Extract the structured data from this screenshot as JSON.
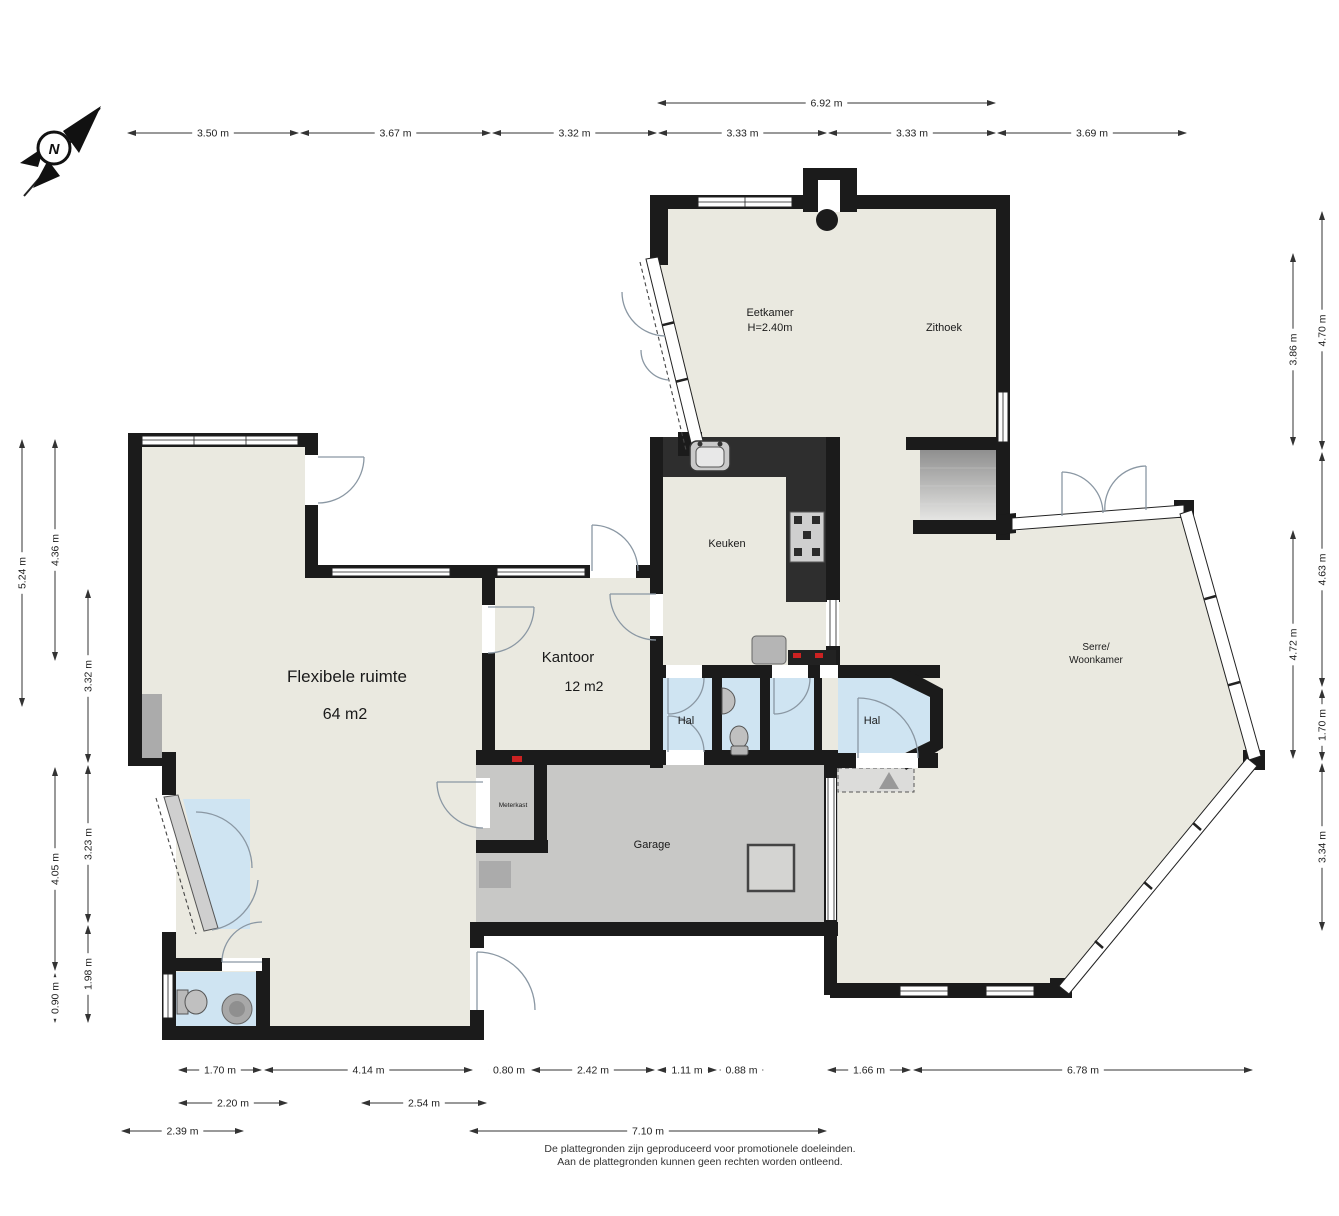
{
  "compass": {
    "north_label": "N"
  },
  "footer": {
    "line1": "De plattegronden zijn geproduceerd voor promotionele doeleinden.",
    "line2": "Aan de plattegronden kunnen geen rechten worden ontleend."
  },
  "colors": {
    "wall": "#1b1b1b",
    "floor": "#eae9e0",
    "hal": "#cfe4f2",
    "garage": "#c8c8c6",
    "counter": "#2e2e2e",
    "red": "#cc2222"
  },
  "rooms": [
    {
      "id": "eetkamer",
      "lines": [
        "Eetkamer",
        "H=2.40m"
      ],
      "x": 770,
      "y": 316,
      "size": 11,
      "lh": 15
    },
    {
      "id": "zithoek",
      "lines": [
        "Zithoek"
      ],
      "x": 944,
      "y": 331,
      "size": 11,
      "lh": 13
    },
    {
      "id": "keuken",
      "lines": [
        "Keuken"
      ],
      "x": 727,
      "y": 547,
      "size": 11,
      "lh": 13
    },
    {
      "id": "kantoor",
      "lines": [
        "Kantoor"
      ],
      "x": 568,
      "y": 662,
      "size": 15,
      "lh": 17
    },
    {
      "id": "kantoor-area",
      "lines": [
        "12 m2"
      ],
      "x": 584,
      "y": 691,
      "size": 14,
      "lh": 16
    },
    {
      "id": "flexibele-ruimte",
      "lines": [
        "Flexibele ruimte"
      ],
      "x": 347,
      "y": 682,
      "size": 17,
      "lh": 19
    },
    {
      "id": "flex-area",
      "lines": [
        "64 m2"
      ],
      "x": 345,
      "y": 719,
      "size": 16,
      "lh": 18
    },
    {
      "id": "hal-1",
      "lines": [
        "Hal"
      ],
      "x": 686,
      "y": 724,
      "size": 11,
      "lh": 13
    },
    {
      "id": "hal-2",
      "lines": [
        "Hal"
      ],
      "x": 872,
      "y": 724,
      "size": 11,
      "lh": 13
    },
    {
      "id": "serre-woonkamer",
      "lines": [
        "Serre/",
        "Woonkamer"
      ],
      "x": 1096,
      "y": 650,
      "size": 10,
      "lh": 13
    },
    {
      "id": "garage",
      "lines": [
        "Garage"
      ],
      "x": 652,
      "y": 848,
      "size": 11,
      "lh": 13
    },
    {
      "id": "meterkast",
      "lines": [
        "Meterkast"
      ],
      "x": 513,
      "y": 807,
      "size": 6.5,
      "lh": 8
    }
  ],
  "dimensions": {
    "items": [
      {
        "label": "6.92 m",
        "dir": "h",
        "x1": 658,
        "x2": 995,
        "y": 103
      },
      {
        "label": "3.50 m",
        "dir": "h",
        "x1": 128,
        "x2": 298,
        "y": 133
      },
      {
        "label": "3.67 m",
        "dir": "h",
        "x1": 301,
        "x2": 490,
        "y": 133
      },
      {
        "label": "3.32 m",
        "dir": "h",
        "x1": 493,
        "x2": 656,
        "y": 133
      },
      {
        "label": "3.33 m",
        "dir": "h",
        "x1": 659,
        "x2": 826,
        "y": 133
      },
      {
        "label": "3.33 m",
        "dir": "h",
        "x1": 829,
        "x2": 995,
        "y": 133
      },
      {
        "label": "3.69 m",
        "dir": "h",
        "x1": 998,
        "x2": 1186,
        "y": 133
      },
      {
        "label": "5.24 m",
        "dir": "v",
        "x": 22,
        "y1": 440,
        "y2": 706
      },
      {
        "label": "4.36 m",
        "dir": "v",
        "x": 55,
        "y1": 440,
        "y2": 660
      },
      {
        "label": "3.32 m",
        "dir": "v",
        "x": 88,
        "y1": 590,
        "y2": 762
      },
      {
        "label": "4.05 m",
        "dir": "v",
        "x": 55,
        "y1": 768,
        "y2": 970
      },
      {
        "label": "0.90 m",
        "dir": "v",
        "x": 55,
        "y1": 974,
        "y2": 1022
      },
      {
        "label": "3.23 m",
        "dir": "v",
        "x": 88,
        "y1": 766,
        "y2": 922
      },
      {
        "label": "1.98 m",
        "dir": "v",
        "x": 88,
        "y1": 926,
        "y2": 1022
      },
      {
        "label": "3.86 m",
        "dir": "v",
        "x": 1293,
        "y1": 254,
        "y2": 445
      },
      {
        "label": "4.72 m",
        "dir": "v",
        "x": 1293,
        "y1": 531,
        "y2": 758
      },
      {
        "label": "4.70 m",
        "dir": "v",
        "x": 1322,
        "y1": 212,
        "y2": 449
      },
      {
        "label": "4.63 m",
        "dir": "v",
        "x": 1322,
        "y1": 453,
        "y2": 686
      },
      {
        "label": "1.70 m",
        "dir": "v",
        "x": 1322,
        "y1": 690,
        "y2": 760
      },
      {
        "label": "3.34 m",
        "dir": "v",
        "x": 1322,
        "y1": 764,
        "y2": 930
      },
      {
        "label": "1.70 m",
        "dir": "h",
        "x1": 179,
        "x2": 261,
        "y": 1070
      },
      {
        "label": "4.14 m",
        "dir": "h",
        "x1": 265,
        "x2": 472,
        "y": 1070
      },
      {
        "label": "0.80 m",
        "dir": "h",
        "x1": 489,
        "x2": 529,
        "y": 1070
      },
      {
        "label": "2.42 m",
        "dir": "h",
        "x1": 532,
        "x2": 654,
        "y": 1070
      },
      {
        "label": "1.11 m",
        "dir": "h",
        "x1": 658,
        "x2": 716,
        "y": 1070
      },
      {
        "label": "0.88 m",
        "dir": "h",
        "x1": 720,
        "x2": 763,
        "y": 1070
      },
      {
        "label": "1.66 m",
        "dir": "h",
        "x1": 828,
        "x2": 910,
        "y": 1070
      },
      {
        "label": "6.78 m",
        "dir": "h",
        "x1": 914,
        "x2": 1252,
        "y": 1070
      },
      {
        "label": "2.20 m",
        "dir": "h",
        "x1": 179,
        "x2": 287,
        "y": 1103
      },
      {
        "label": "2.54 m",
        "dir": "h",
        "x1": 362,
        "x2": 486,
        "y": 1103
      },
      {
        "label": "2.39 m",
        "dir": "h",
        "x1": 122,
        "x2": 243,
        "y": 1131
      },
      {
        "label": "7.10 m",
        "dir": "h",
        "x1": 470,
        "x2": 826,
        "y": 1131
      }
    ]
  }
}
